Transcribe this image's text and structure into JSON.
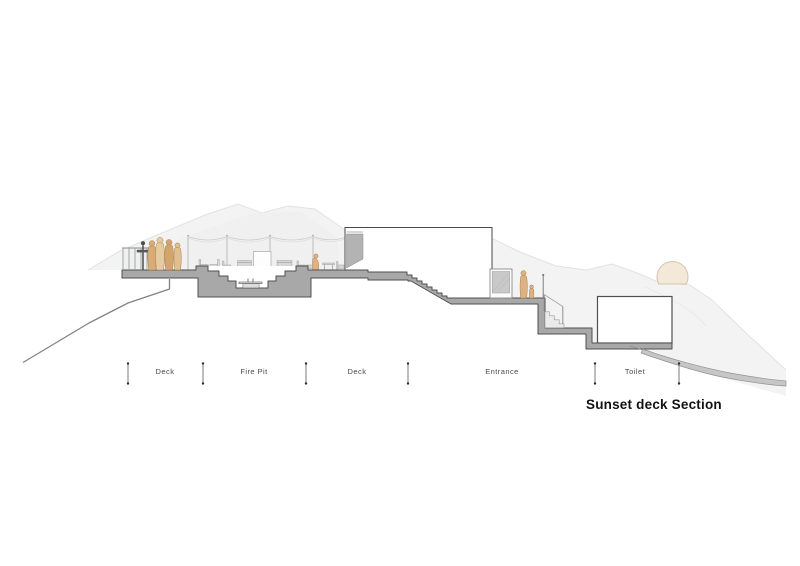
{
  "drawing": {
    "title": "Sunset deck Section",
    "labels": [
      {
        "text": "Deck"
      },
      {
        "text": "Fire Pit"
      },
      {
        "text": "Deck"
      },
      {
        "text": "Entrance"
      },
      {
        "text": "Toilet"
      }
    ],
    "colors": {
      "concrete": "#a8a8a8",
      "outline": "#4f4f4f",
      "terrain_light": "#f3f3f3",
      "terrain_mid": "#ececec",
      "people_tan": "#ddb183",
      "sun_fill": "#f4e8d8",
      "sun_stroke": "#d7c4ac",
      "furniture": "#d6d6d6",
      "label_text": "#4a4a4a",
      "title_text": "#121212"
    }
  }
}
